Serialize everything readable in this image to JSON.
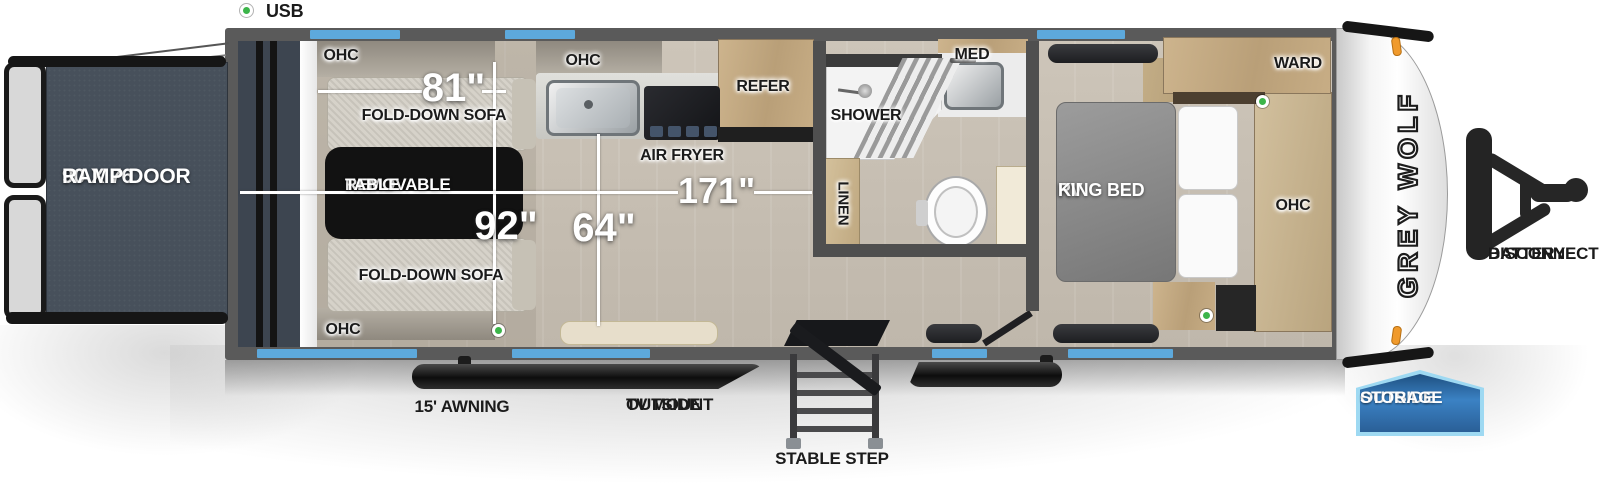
{
  "legend": {
    "usb": "USB"
  },
  "rear_ramp": {
    "size": "90 X 76",
    "name": "RAMP DOOR"
  },
  "garage": {
    "ohc_top": "OHC",
    "ohc_bottom": "OHC",
    "sofa_top": "FOLD-DOWN SOFA",
    "sofa_bottom": "FOLD-DOWN SOFA",
    "table_line1": "REMOVABLE",
    "table_line2": "TABLE",
    "dim_sofa_length": "81\"",
    "dim_garage_length": "92\""
  },
  "kitchen": {
    "ohc": "OHC",
    "air_fryer": "AIR FRYER",
    "refer": "REFER",
    "dim_interior_width": "64\"",
    "dim_living_length": "171\""
  },
  "bathroom": {
    "shower": "SHOWER",
    "med": "MED",
    "linen": "LINEN"
  },
  "bedroom": {
    "bed_line1": "RV",
    "bed_line2": "KING BED",
    "ward": "WARD",
    "ohc": "OHC"
  },
  "front": {
    "brand": "GREY WOLF",
    "battery_line1": "BATTERY",
    "battery_line2": "DISCONNECT"
  },
  "exterior": {
    "awning": "15' AWNING",
    "tv_mount_line1": "OUTSIDE",
    "tv_mount_line2": "TV MOUNT",
    "stable_step": "STABLE STEP",
    "storage_line1": "OUTSIDE",
    "storage_line2": "STORAGE"
  },
  "colors": {
    "window_blue": "#5da9dc",
    "usb_green": "#3cb54a",
    "storage_blue": "#2f6fad",
    "storage_border": "#9ed9f2",
    "marker_orange": "#f09a2c",
    "table_black": "#121212",
    "ramp_slate": "#47505b"
  }
}
